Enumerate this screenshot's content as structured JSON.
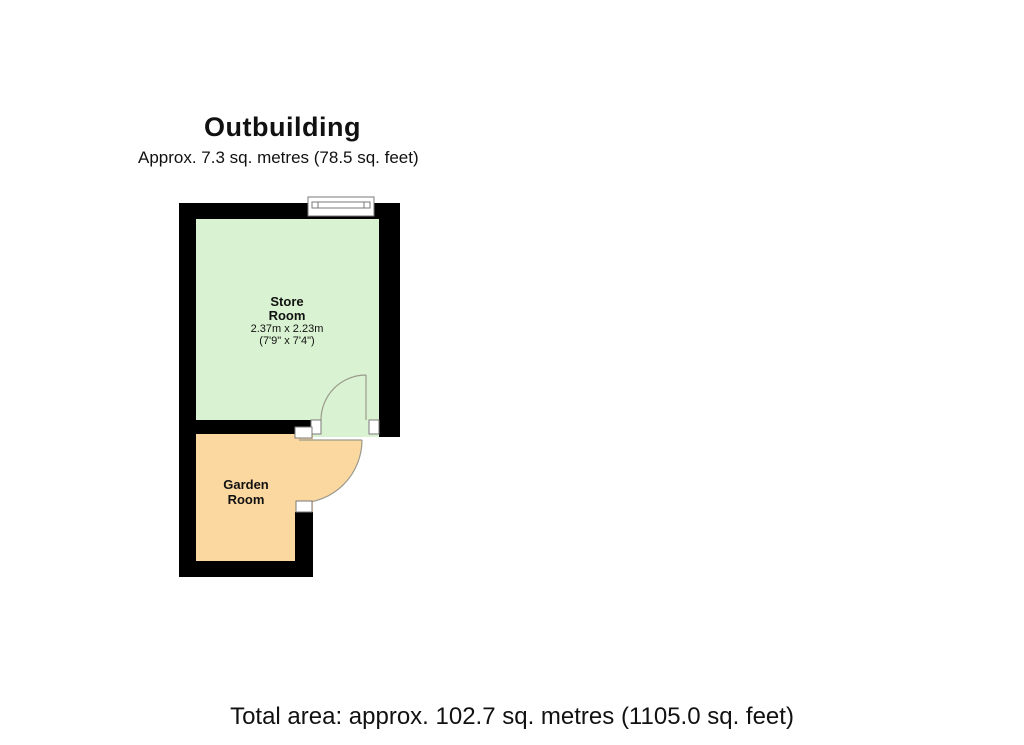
{
  "header": {
    "title": "Outbuilding",
    "subtitle": "Approx. 7.3 sq. metres (78.5 sq. feet)"
  },
  "footer": {
    "total_area": "Total area: approx. 102.7 sq. metres (1105.0 sq. feet)"
  },
  "floorplan": {
    "rooms": [
      {
        "name_line1": "Store",
        "name_line2": "Room",
        "dimensions_metric": "2.37m x 2.23m",
        "dimensions_imperial": "(7'9\" x 7'4\")",
        "fill": "#d9f2d1"
      },
      {
        "name_line1": "Garden",
        "name_line2": "Room",
        "fill": "#fcd8a1"
      }
    ],
    "colors": {
      "wall": "#000000",
      "store_fill": "#d9f2d1",
      "garden_fill": "#fcd8a1",
      "symbol_stroke": "#7a7a7a",
      "door_arc_stroke": "#9a9a8c"
    }
  }
}
